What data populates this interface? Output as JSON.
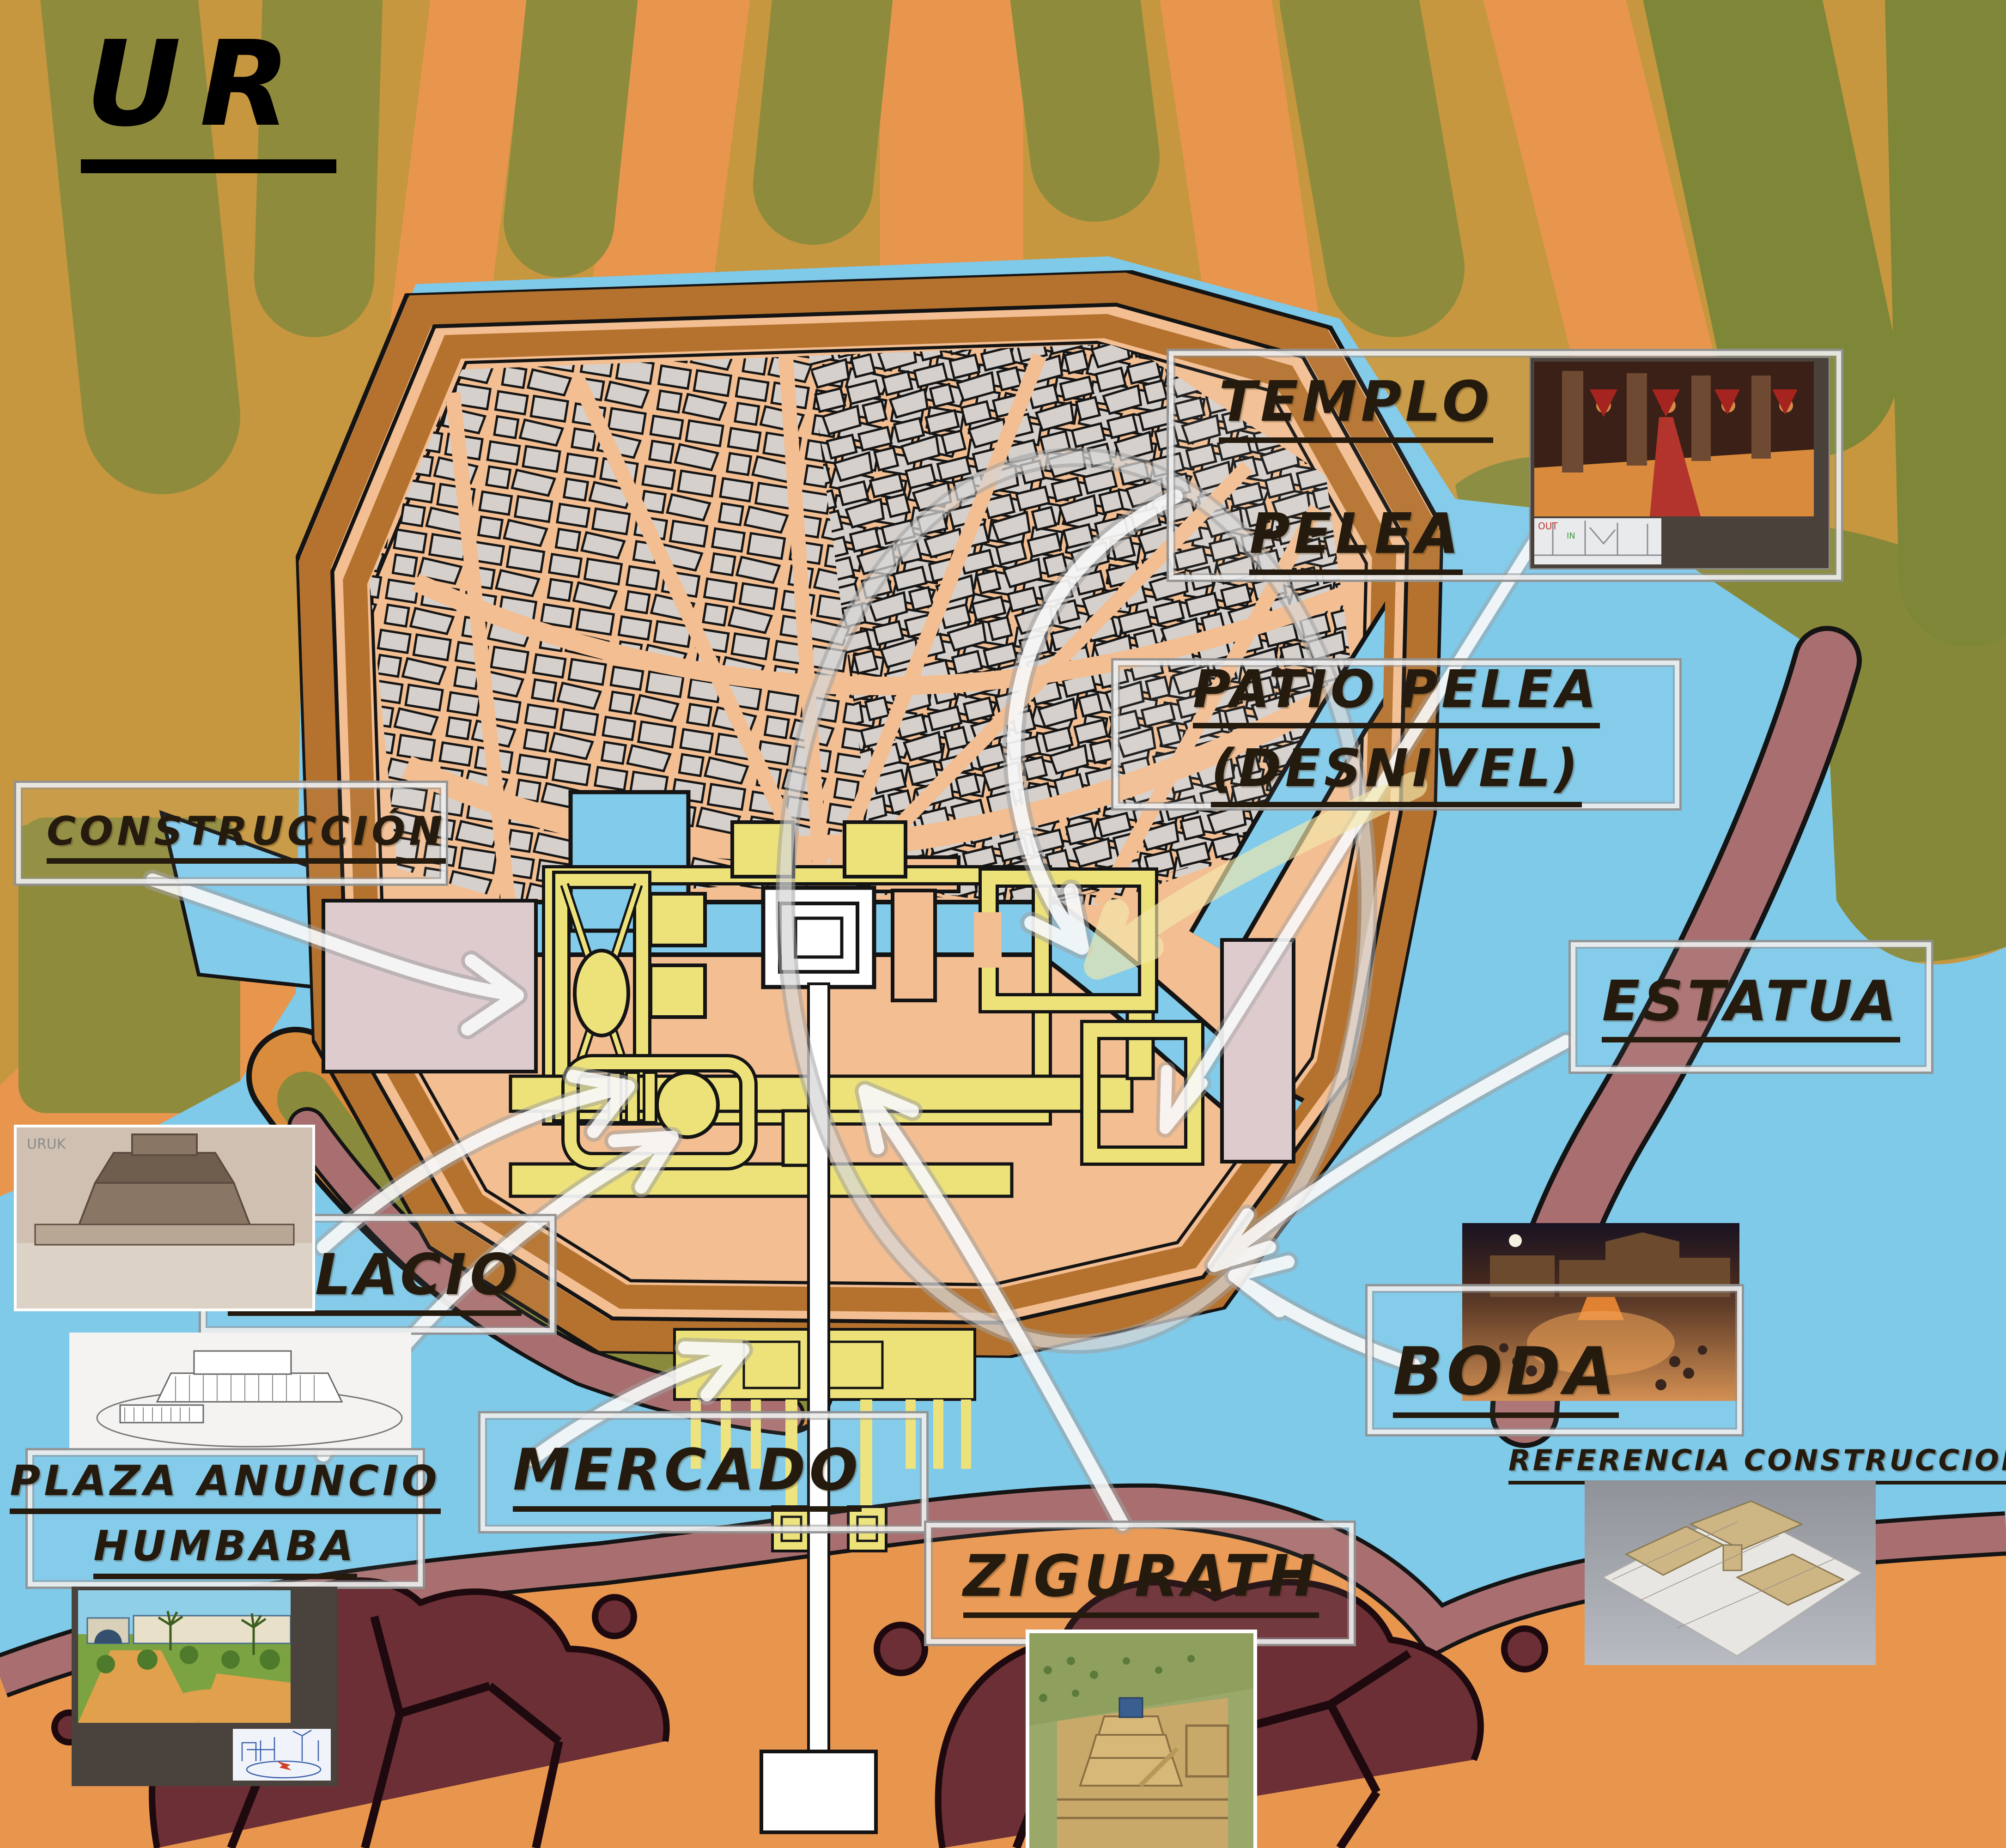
{
  "title": {
    "text": "UR"
  },
  "labels": {
    "construccion": {
      "text": "CONSTRUCCIÓN"
    },
    "templo": {
      "line1": "TEMPLO",
      "line2": "PELEA"
    },
    "patio": {
      "line1": "PATIO PELEA",
      "line2": "(DESNIVEL)"
    },
    "estatua": {
      "text": "ESTATUA"
    },
    "palacio": {
      "text": "PALACIO"
    },
    "boda": {
      "text": "BODA"
    },
    "mercado": {
      "text": "MERCADO"
    },
    "plaza": {
      "line1": "PLAZA ANUNCIO",
      "line2": "HUMBABA"
    },
    "zigurath": {
      "text": "ZIGURATH"
    },
    "referencia": {
      "text": "REFERENCIA CONSTRUCCIONES"
    }
  },
  "images": {
    "uruk_caption": "URUK",
    "sketch_out": "OUT",
    "sketch_in": "IN"
  },
  "colors": {
    "water": "#7FC9E9",
    "land_ochre": "#C6973F",
    "land_orange": "#E8964E",
    "olive": "#8F8B3D",
    "dark_olive": "#7E8638",
    "city_peach": "#F2BE92",
    "wall_brown": "#B5722E",
    "maze_gray": "#D6D0CC",
    "canal_blue": "#82CBEA",
    "temple_yellow": "#EDE279",
    "building_pink": "#DECBCE",
    "bank_mauve": "#A96F70",
    "rock_maroon": "#6B2F35",
    "label_ink": "#241A0E"
  }
}
